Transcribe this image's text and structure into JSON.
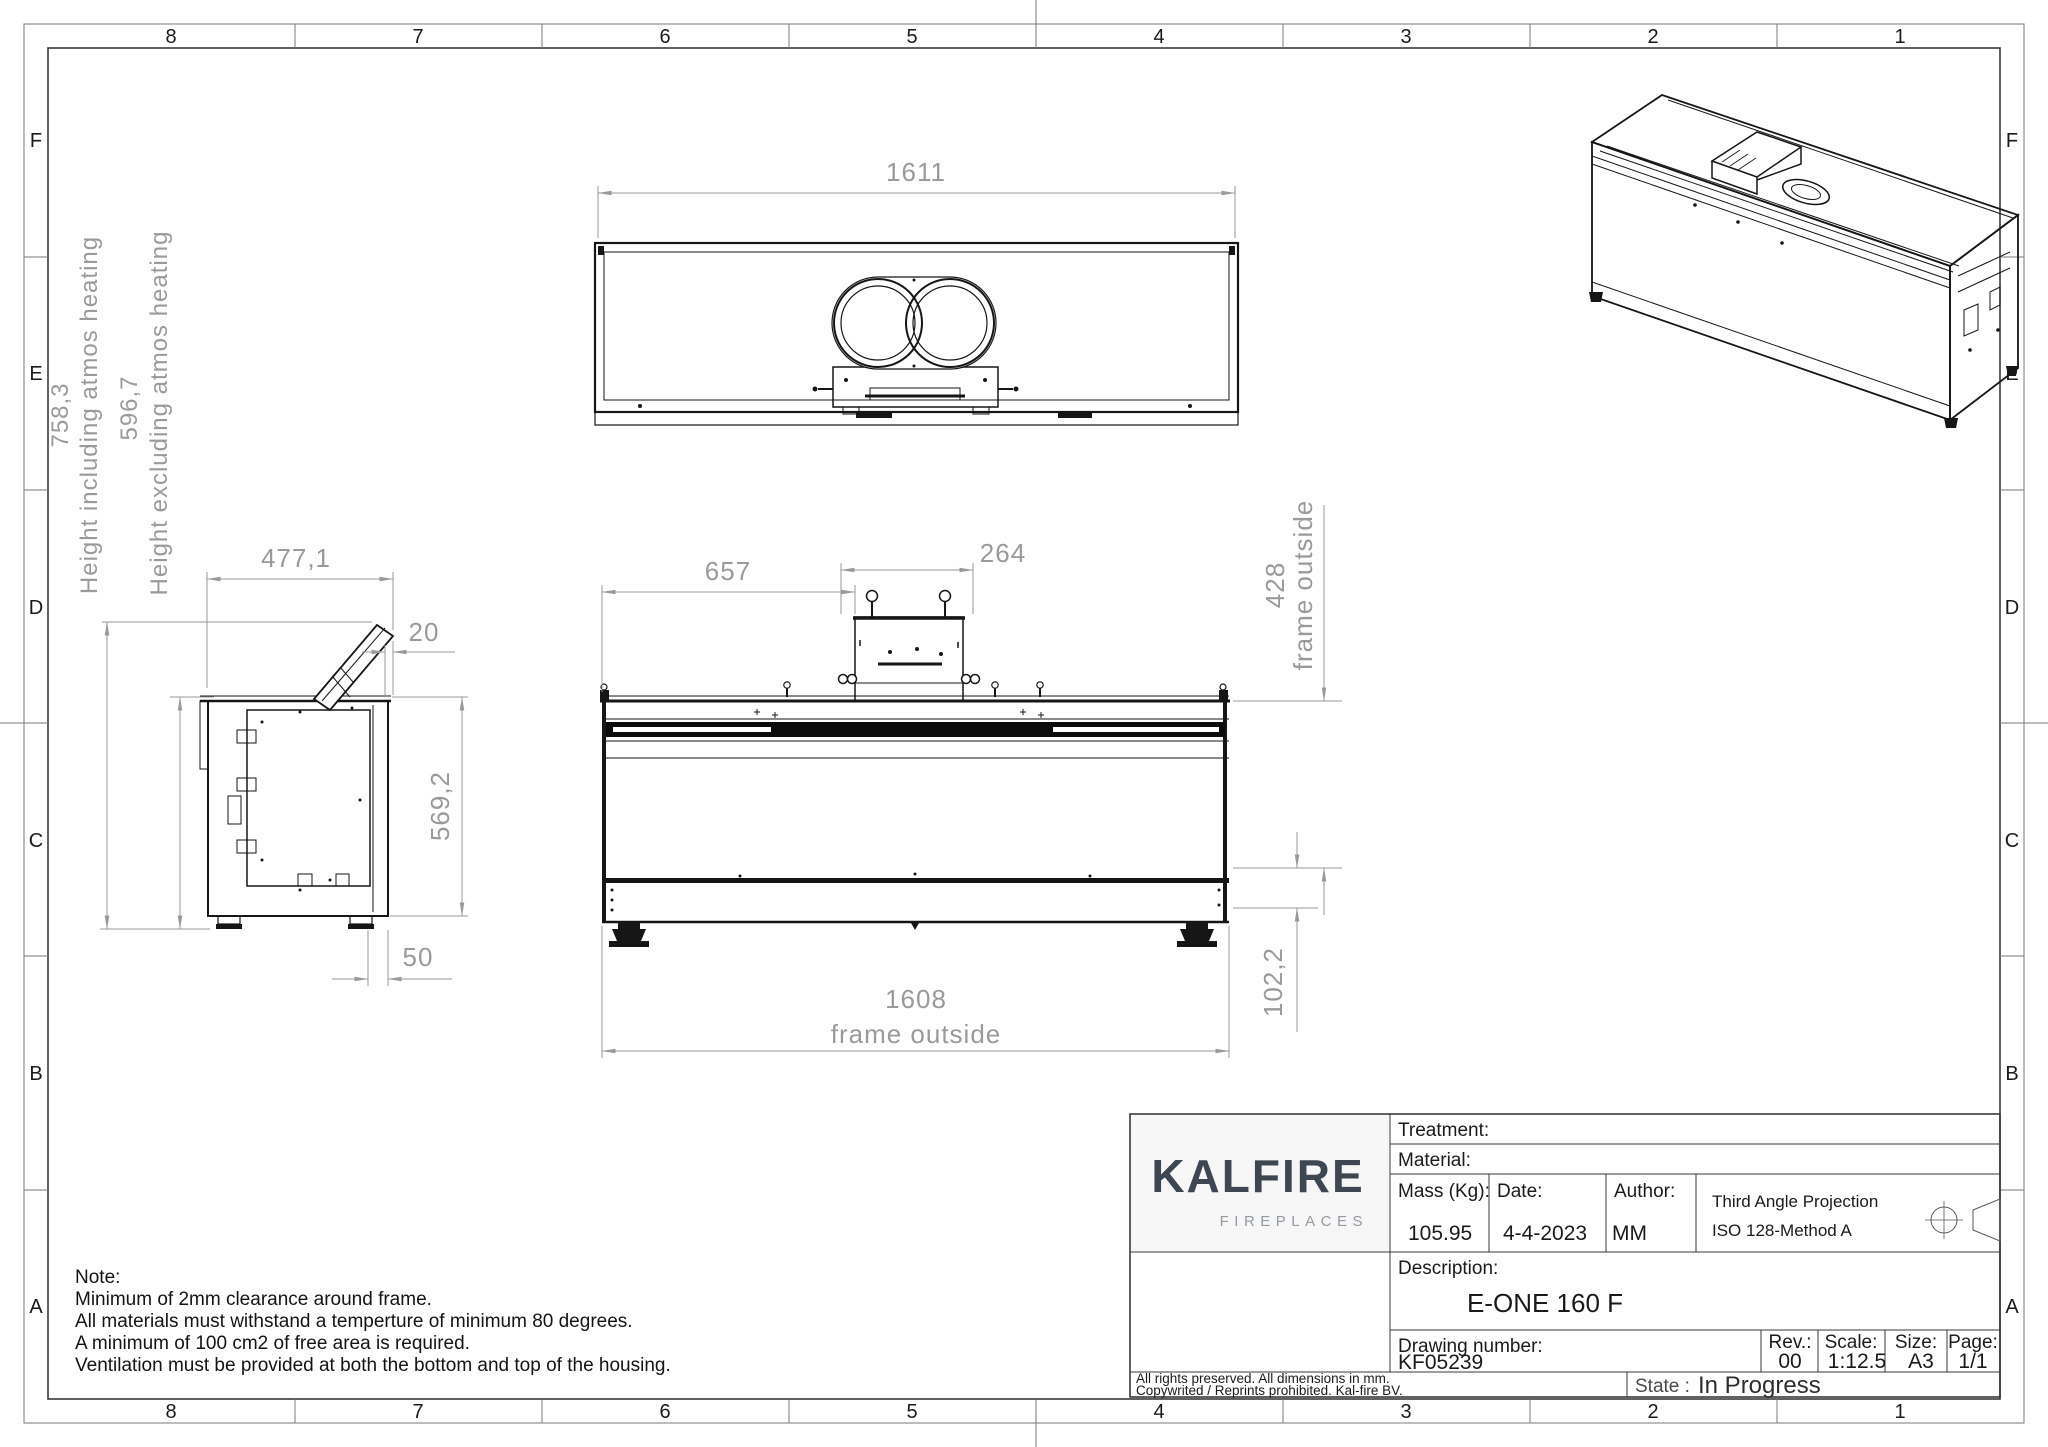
{
  "sheet": {
    "grid_columns": [
      "8",
      "7",
      "6",
      "5",
      "4",
      "3",
      "2",
      "1"
    ],
    "grid_rows": [
      "F",
      "E",
      "D",
      "C",
      "B",
      "A"
    ]
  },
  "views": {
    "top": {
      "width": "1611"
    },
    "front": {
      "offset_left": "657",
      "box_width": "264",
      "frame_height": "428",
      "frame_height_suffix": "frame outside",
      "frame_width": "1608",
      "frame_width_suffix": "frame outside",
      "plinth_height": "102,2"
    },
    "side": {
      "depth": "477,1",
      "flap_thickness": "20",
      "inner_height": "569,2",
      "foot_offset": "50",
      "height_including": "758,3",
      "height_including_label": "Height including atmos heating",
      "height_excluding": "596,7",
      "height_excluding_label": "Height excluding atmos heating"
    }
  },
  "notes": {
    "title": "Note:",
    "lines": [
      "Minimum of 2mm clearance around frame.",
      "All materials must withstand a temperture of minimum 80 degrees.",
      "A minimum of 100 cm2 of free area is required.",
      "Ventilation must be provided at both the bottom and top of the housing."
    ]
  },
  "title_block": {
    "brand": {
      "name": "KALFIRE",
      "tagline": "FIREPLACES"
    },
    "treatment_label": "Treatment:",
    "material_label": "Material:",
    "mass_label": "Mass (Kg):",
    "mass_value": "105.95",
    "date_label": "Date:",
    "date_value": "4-4-2023",
    "author_label": "Author:",
    "author_value": "MM",
    "projection_line1": "Third Angle Projection",
    "projection_line2": "ISO 128-Method A",
    "description_label": "Description:",
    "description_value": "E-ONE 160 F",
    "drawing_number_label": "Drawing number:",
    "drawing_number_value": "KF05239",
    "rev_label": "Rev.:",
    "rev_value": "00",
    "scale_label": "Scale:",
    "scale_value": "1:12.5",
    "size_label": "Size:",
    "size_value": "A3",
    "page_label": "Page:",
    "page_value": "1/1",
    "copyright_line1": "All rights preserved. All dimensions in mm.",
    "copyright_line2": "Copywrited / Reprints prohibited. Kal-fire BV.",
    "state_label": "State :",
    "state_value": "In Progress"
  }
}
